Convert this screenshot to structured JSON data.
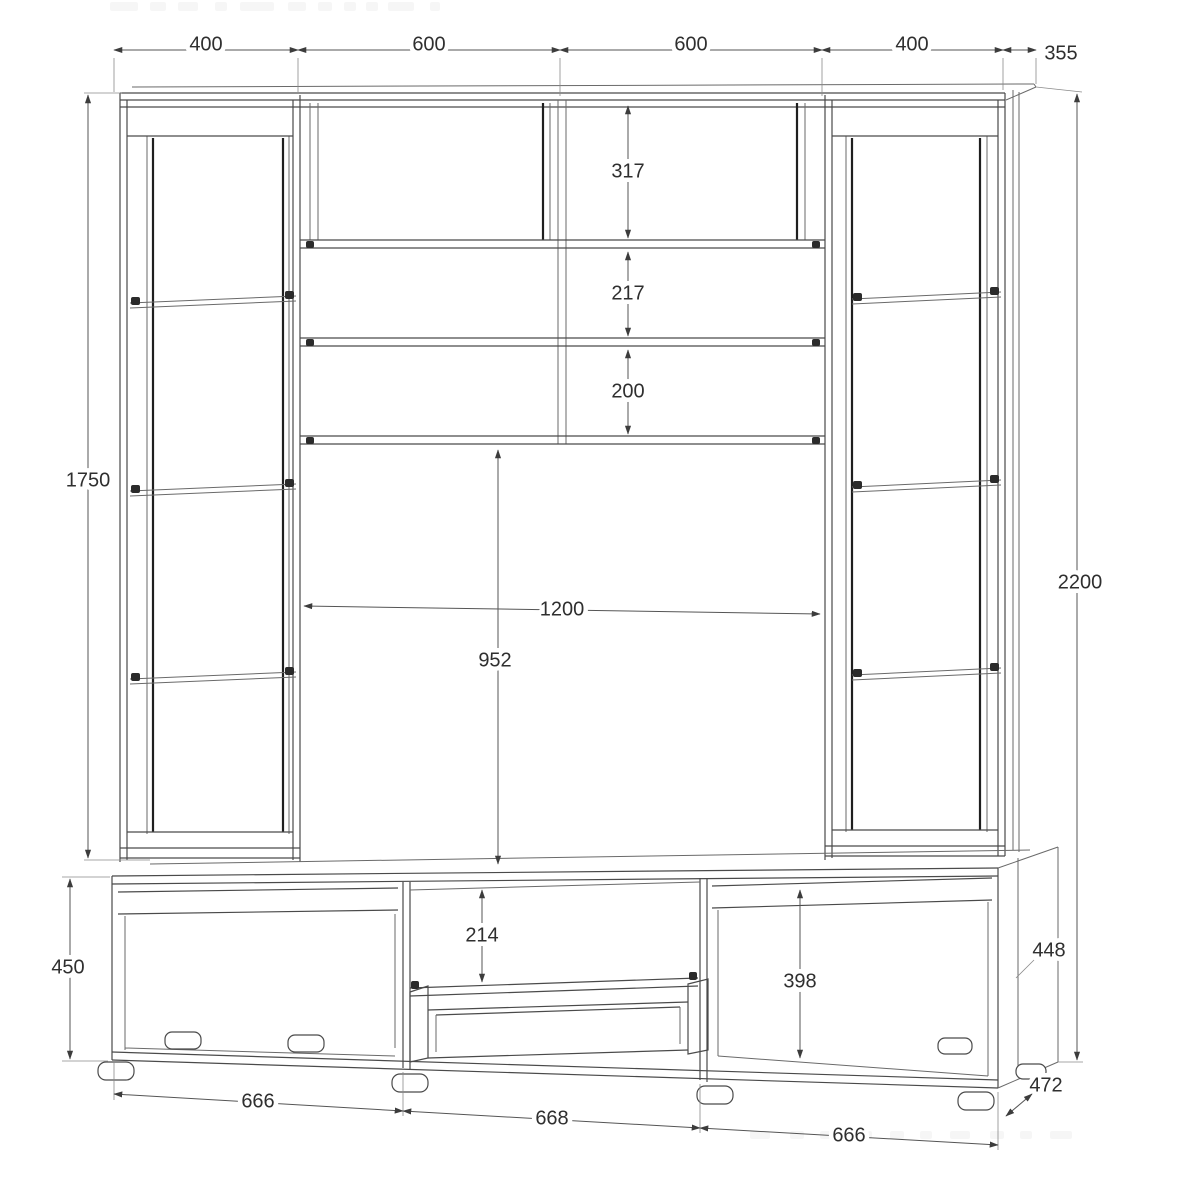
{
  "page": {
    "background": "#ffffff"
  },
  "drawing": {
    "type": "furniture-technical-drawing",
    "subject": "wall-unit-with-two-display-towers-shelves-and-tv-base",
    "units": "mm",
    "line_color": "#4a4a4a",
    "label_color": "#2f2f2f",
    "dims": {
      "top_left_side": "400",
      "top_left_center": "600",
      "top_right_center": "600",
      "top_right_side": "400",
      "top_depth": "355",
      "tower_height": "1750",
      "base_height": "450",
      "total_height": "2200",
      "upper_shelf_gap_1": "317",
      "upper_shelf_gap_2": "217",
      "upper_shelf_gap_3": "200",
      "tv_niche_width": "1200",
      "tv_niche_height": "952",
      "center_niche_gap": "214",
      "base_inner_height": "398",
      "side_panel_height": "448",
      "base_depth": "472",
      "base_width_left": "666",
      "base_width_center": "668",
      "base_width_right": "666"
    }
  }
}
